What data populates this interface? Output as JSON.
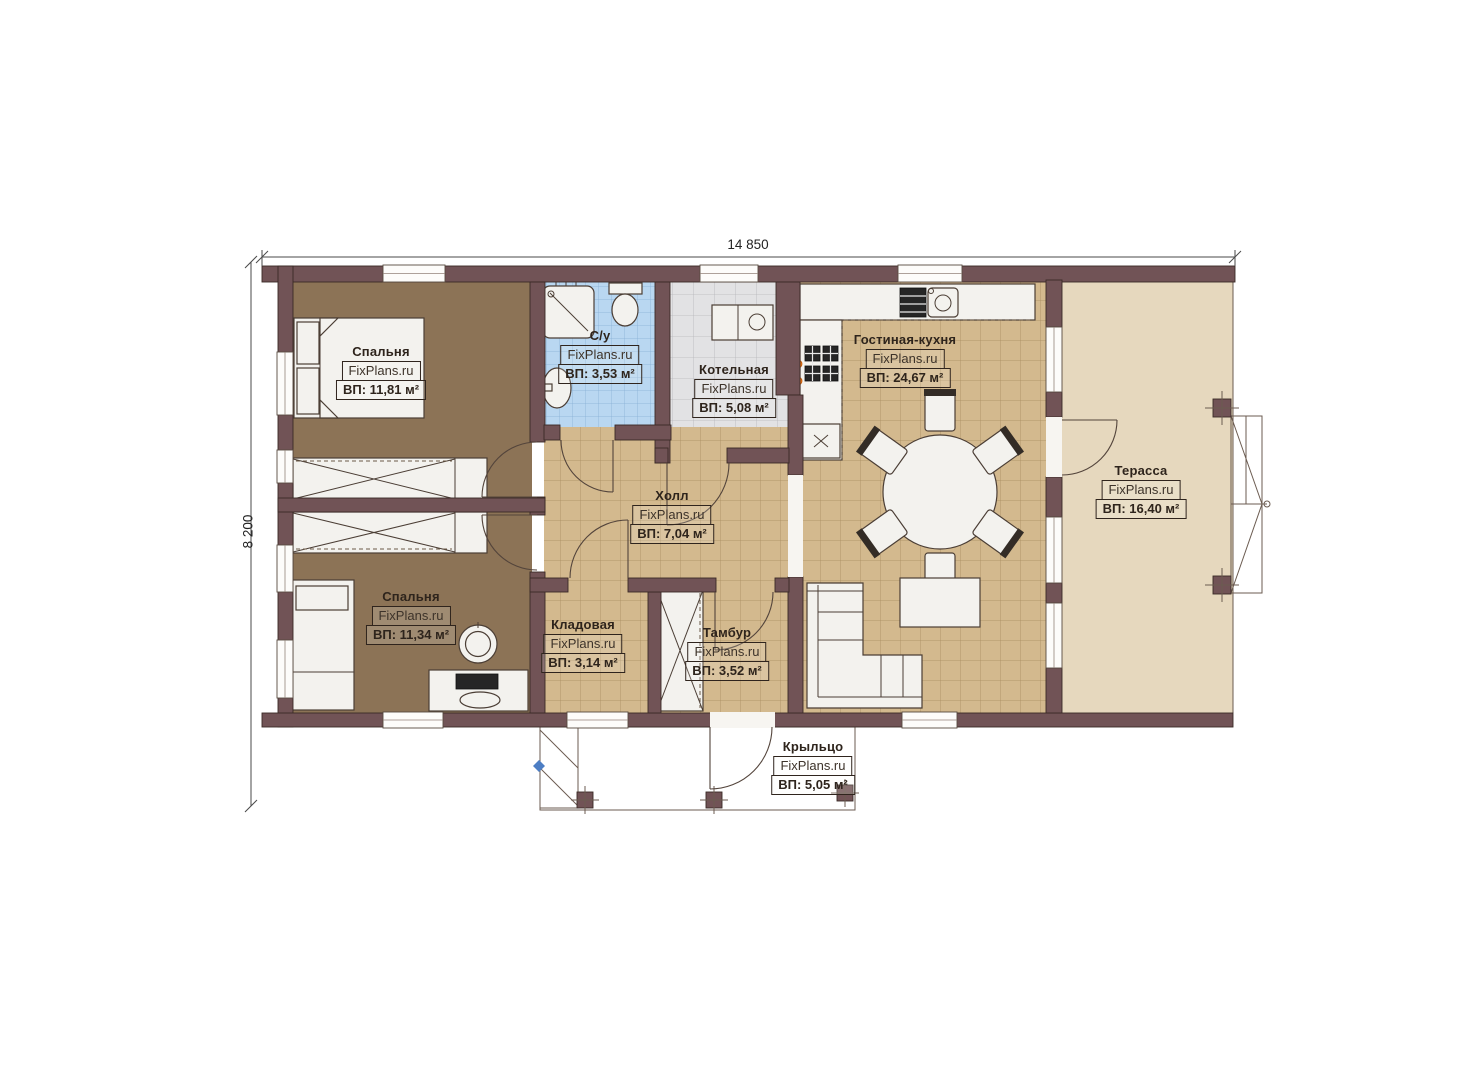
{
  "dimensions": {
    "width_label": "14 850",
    "height_label": "8 200"
  },
  "rooms": [
    {
      "id": "bedroom-1",
      "name": "Спальня",
      "watermark": "FixPlans.ru",
      "area": "ВП: 11,81 м²"
    },
    {
      "id": "bathroom",
      "name": "С/у",
      "watermark": "FixPlans.ru",
      "area": "ВП: 3,53 м²"
    },
    {
      "id": "boiler-room",
      "name": "Котельная",
      "watermark": "FixPlans.ru",
      "area": "ВП: 5,08 м²"
    },
    {
      "id": "living-kitchen",
      "name": "Гостиная-кухня",
      "watermark": "FixPlans.ru",
      "area": "ВП: 24,67 м²"
    },
    {
      "id": "terrace",
      "name": "Терасса",
      "watermark": "FixPlans.ru",
      "area": "ВП: 16,40 м²"
    },
    {
      "id": "hall",
      "name": "Холл",
      "watermark": "FixPlans.ru",
      "area": "ВП: 7,04 м²"
    },
    {
      "id": "bedroom-2",
      "name": "Спальня",
      "watermark": "FixPlans.ru",
      "area": "ВП: 11,34 м²"
    },
    {
      "id": "storage",
      "name": "Кладовая",
      "watermark": "FixPlans.ru",
      "area": "ВП: 3,14 м²"
    },
    {
      "id": "vestibule",
      "name": "Тамбур",
      "watermark": "FixPlans.ru",
      "area": "ВП: 3,52 м²"
    },
    {
      "id": "porch",
      "name": "Крыльцо",
      "watermark": "FixPlans.ru",
      "area": "ВП: 5,05 м²"
    }
  ],
  "palette": {
    "wall": "#715356",
    "line": "#3a2b26",
    "floor-brown": "#8c7356",
    "floor-tan": "#d3b98e",
    "tile-blue": "#b9d7f1",
    "tile-gray": "#e2e2e4",
    "terrace": "#e6d8be",
    "furniture": "#f3f2ee",
    "accent-orange": "#f07818",
    "marker-blue": "#4d7ec4"
  }
}
